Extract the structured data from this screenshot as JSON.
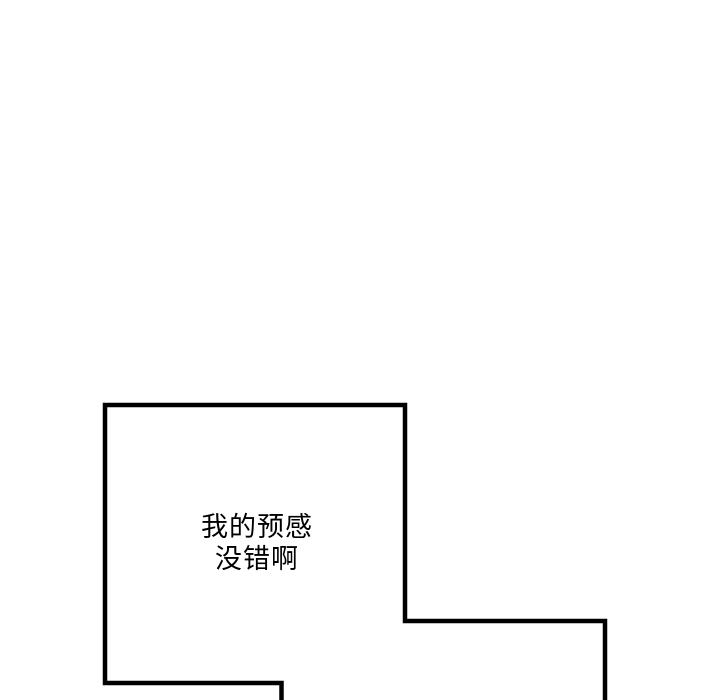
{
  "page": {
    "background_color": "#ffffff",
    "panel_border_color": "#000000",
    "text_color": "#000000"
  },
  "panel": {
    "dialogue": {
      "line1": "我的预感",
      "line2": "没错啊"
    }
  }
}
